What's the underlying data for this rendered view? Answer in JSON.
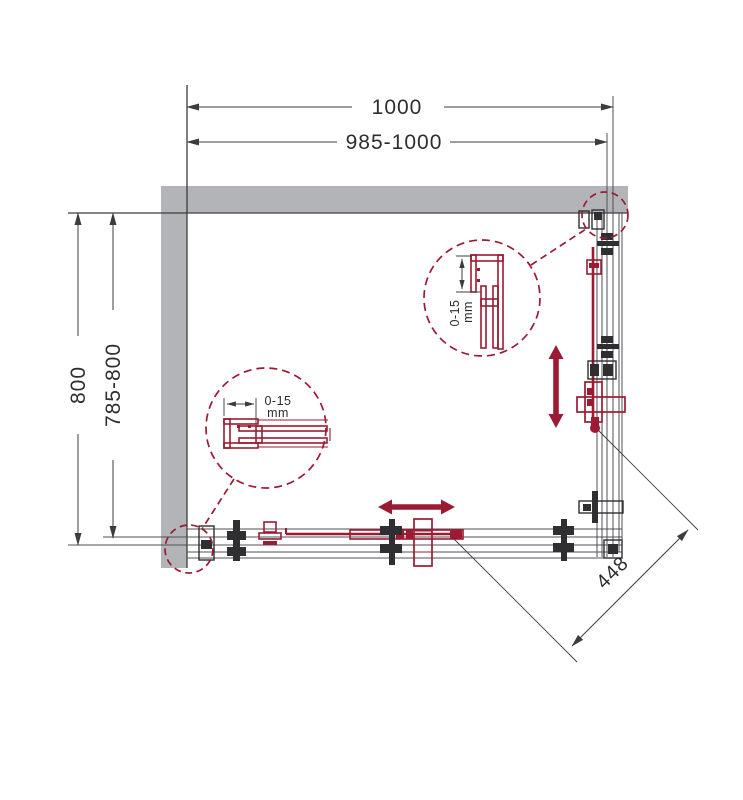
{
  "drawing": {
    "type": "shower-enclosure-corner-entry-top-view",
    "dimensions": {
      "width_total": "1000",
      "width_range": "985-1000",
      "depth_total": "800",
      "depth_range": "785-800",
      "entry_diagonal": "448"
    },
    "details": {
      "top_right_profile": {
        "range": "0-15",
        "unit": "mm"
      },
      "bottom_left_profile": {
        "range": "0-15",
        "unit": "mm"
      }
    },
    "colors": {
      "accent_red": "#9c1b32",
      "wall_gray": "#b2b4b7",
      "line_dark": "#3c3c3e",
      "line_mid": "#505154"
    }
  }
}
